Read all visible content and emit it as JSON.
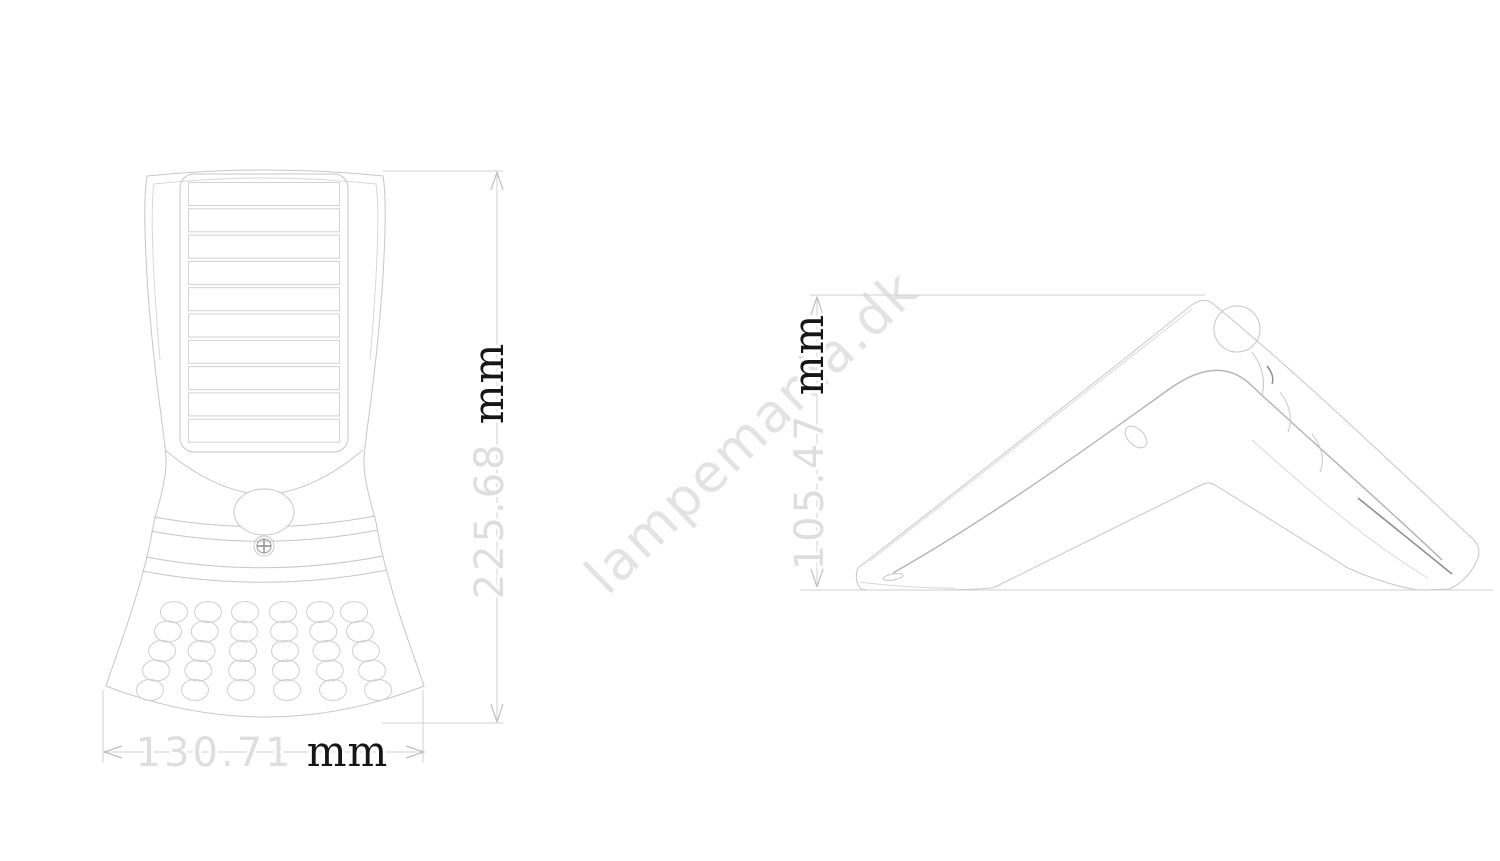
{
  "watermark": {
    "text": "lampemania.dk"
  },
  "dimensions": {
    "front_height": {
      "value": "225.68",
      "unit": "mm"
    },
    "front_width": {
      "value": "130.71",
      "unit": "mm"
    },
    "side_height": {
      "value": "105.47",
      "unit": "mm"
    }
  },
  "colors": {
    "line": "#c6c6c6",
    "line_light": "#d8d8d8",
    "dim_line": "#d2d2d2",
    "dim_value": "#dedede",
    "dim_unit": "#161616",
    "watermark": "#e3e3e3",
    "background": "#ffffff"
  }
}
